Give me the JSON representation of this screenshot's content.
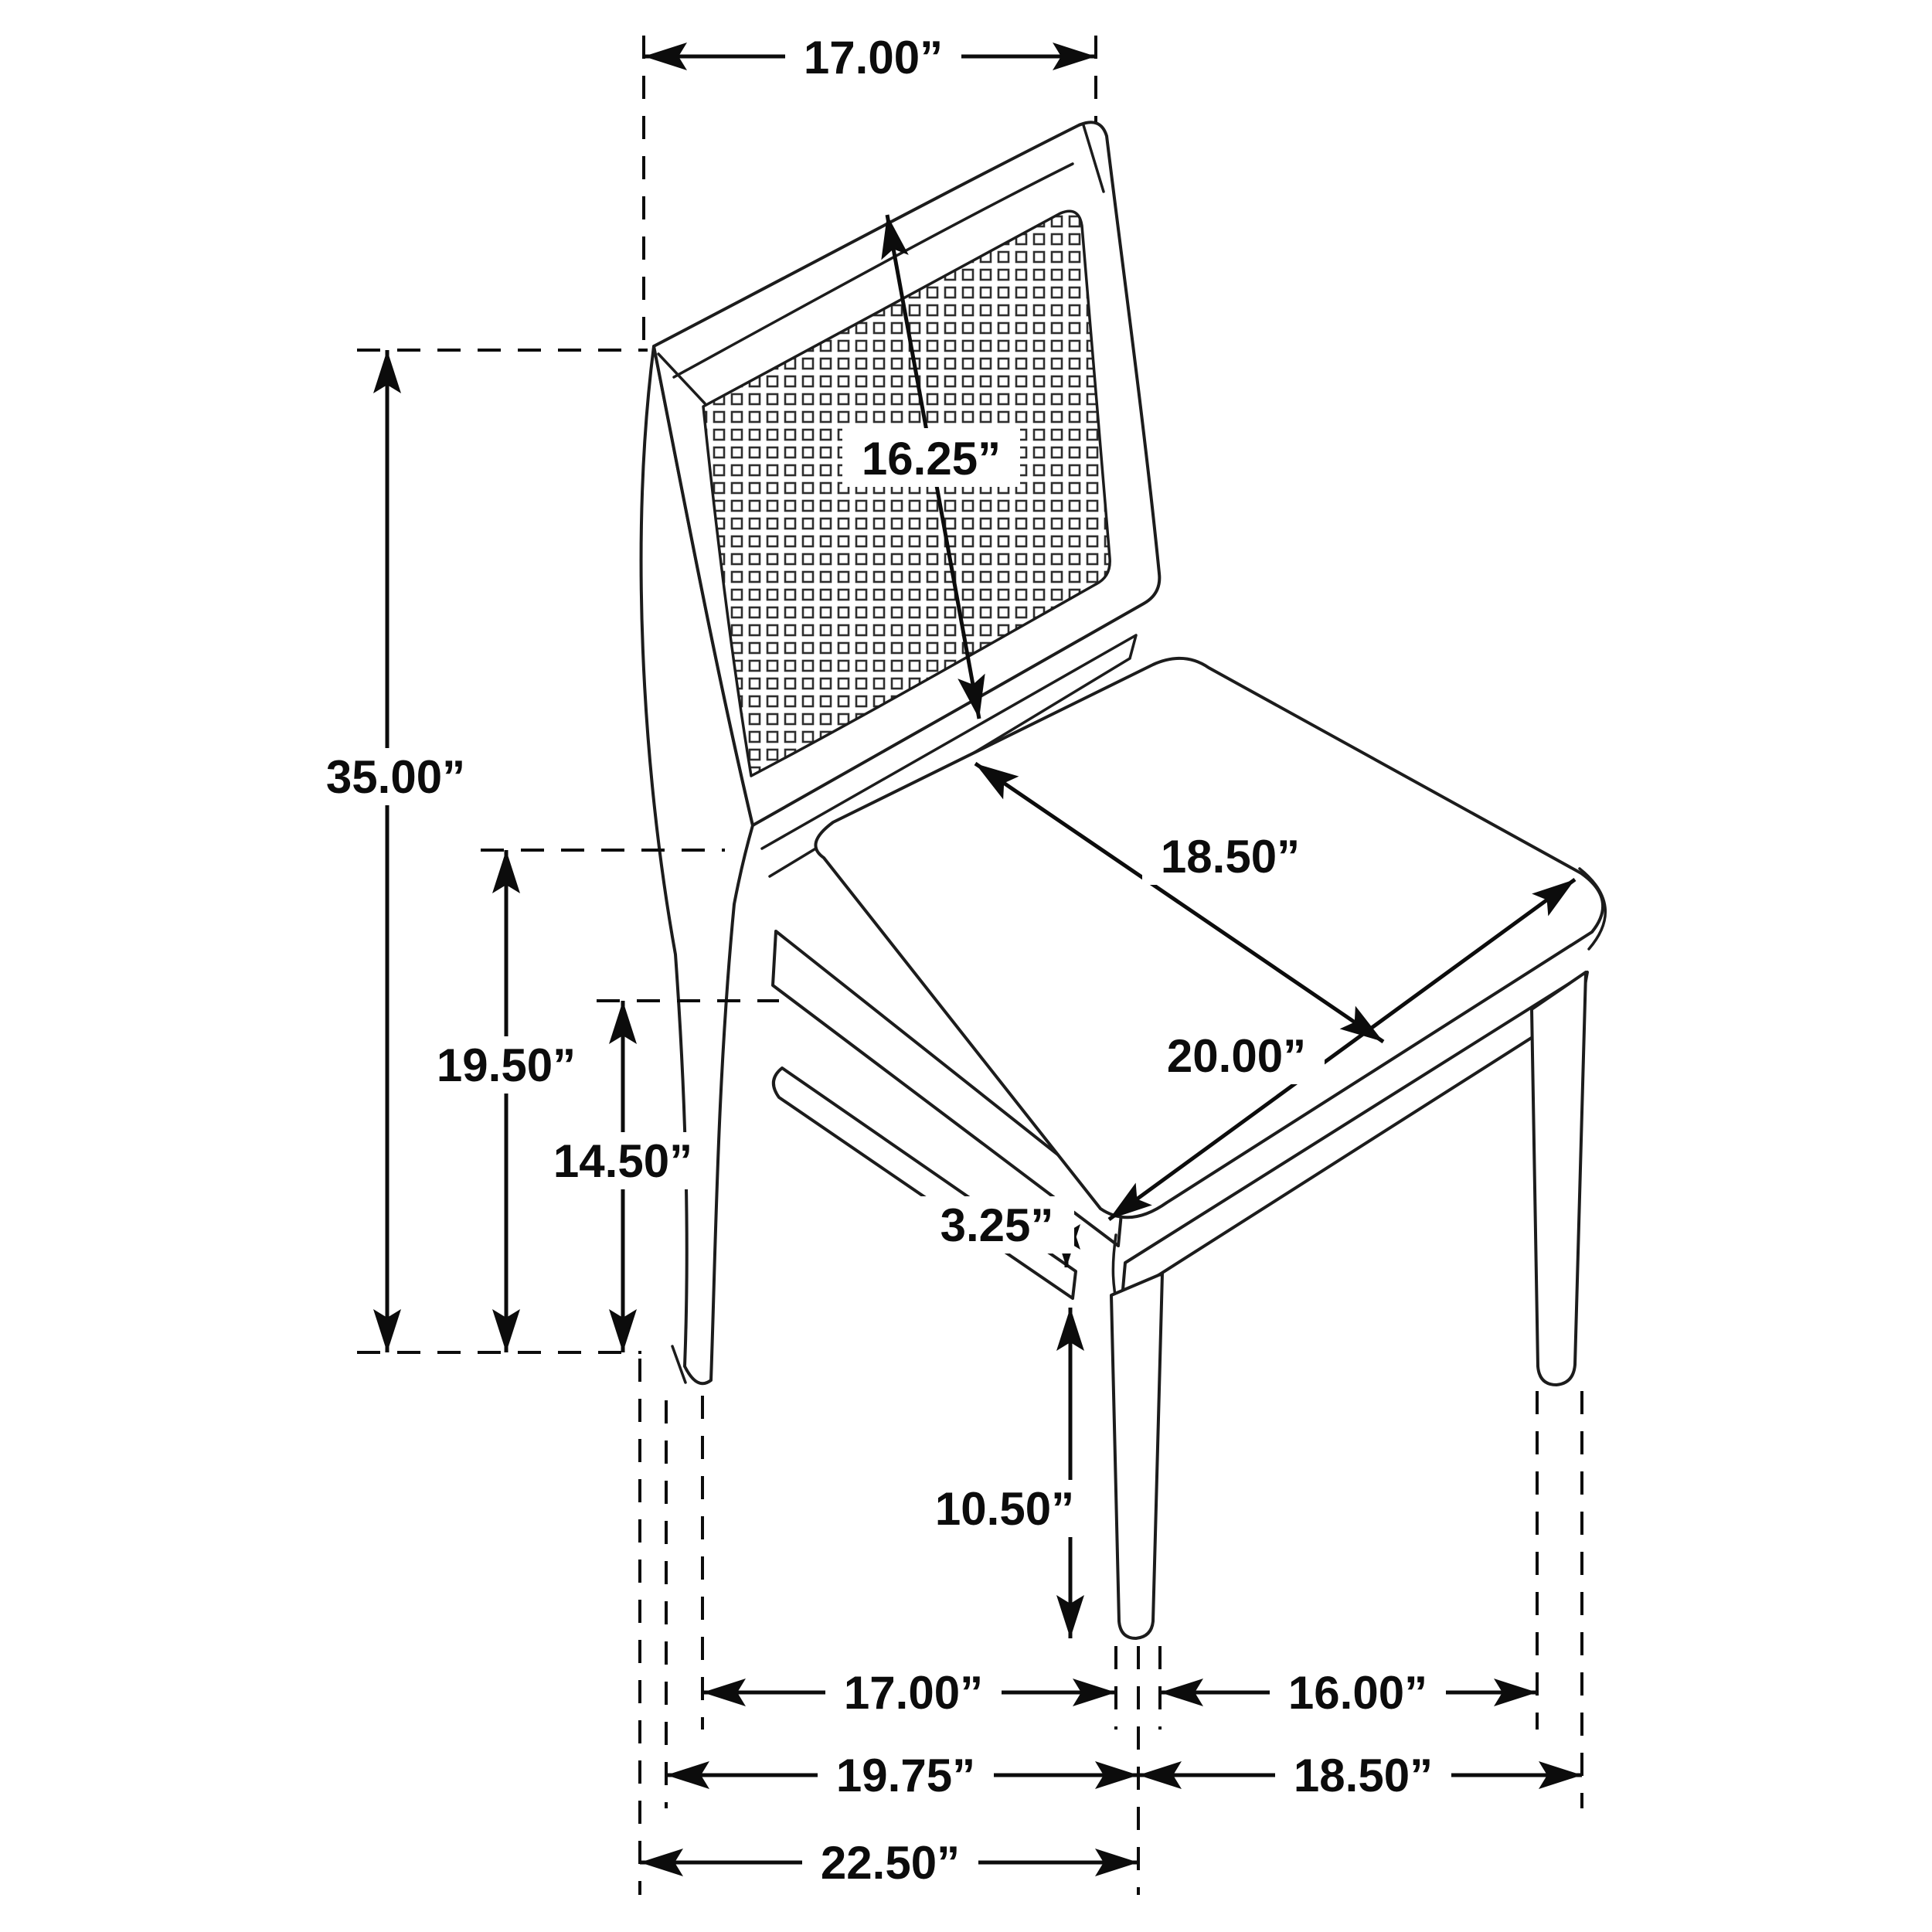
{
  "diagram": {
    "type": "furniture-dimension-drawing",
    "subject": "dining-side-chair-with-cane-back",
    "line_color": "#1c1c1c",
    "background_color": "#ffffff",
    "dimensions": {
      "back_top_width": "17.00”",
      "back_panel_height": "16.25”",
      "overall_height": "35.00”",
      "seat_height": "19.50”",
      "apron_height": "14.50”",
      "seat_depth": "18.50”",
      "seat_width": "20.00”",
      "apron_gap": "3.25”",
      "leg_clearance": "10.50”",
      "front_leg_span": "17.00”",
      "side_leg_span": "16.00”",
      "base_span_left": "19.75”",
      "base_span_right": "18.50”",
      "overall_depth": "22.50”"
    }
  }
}
